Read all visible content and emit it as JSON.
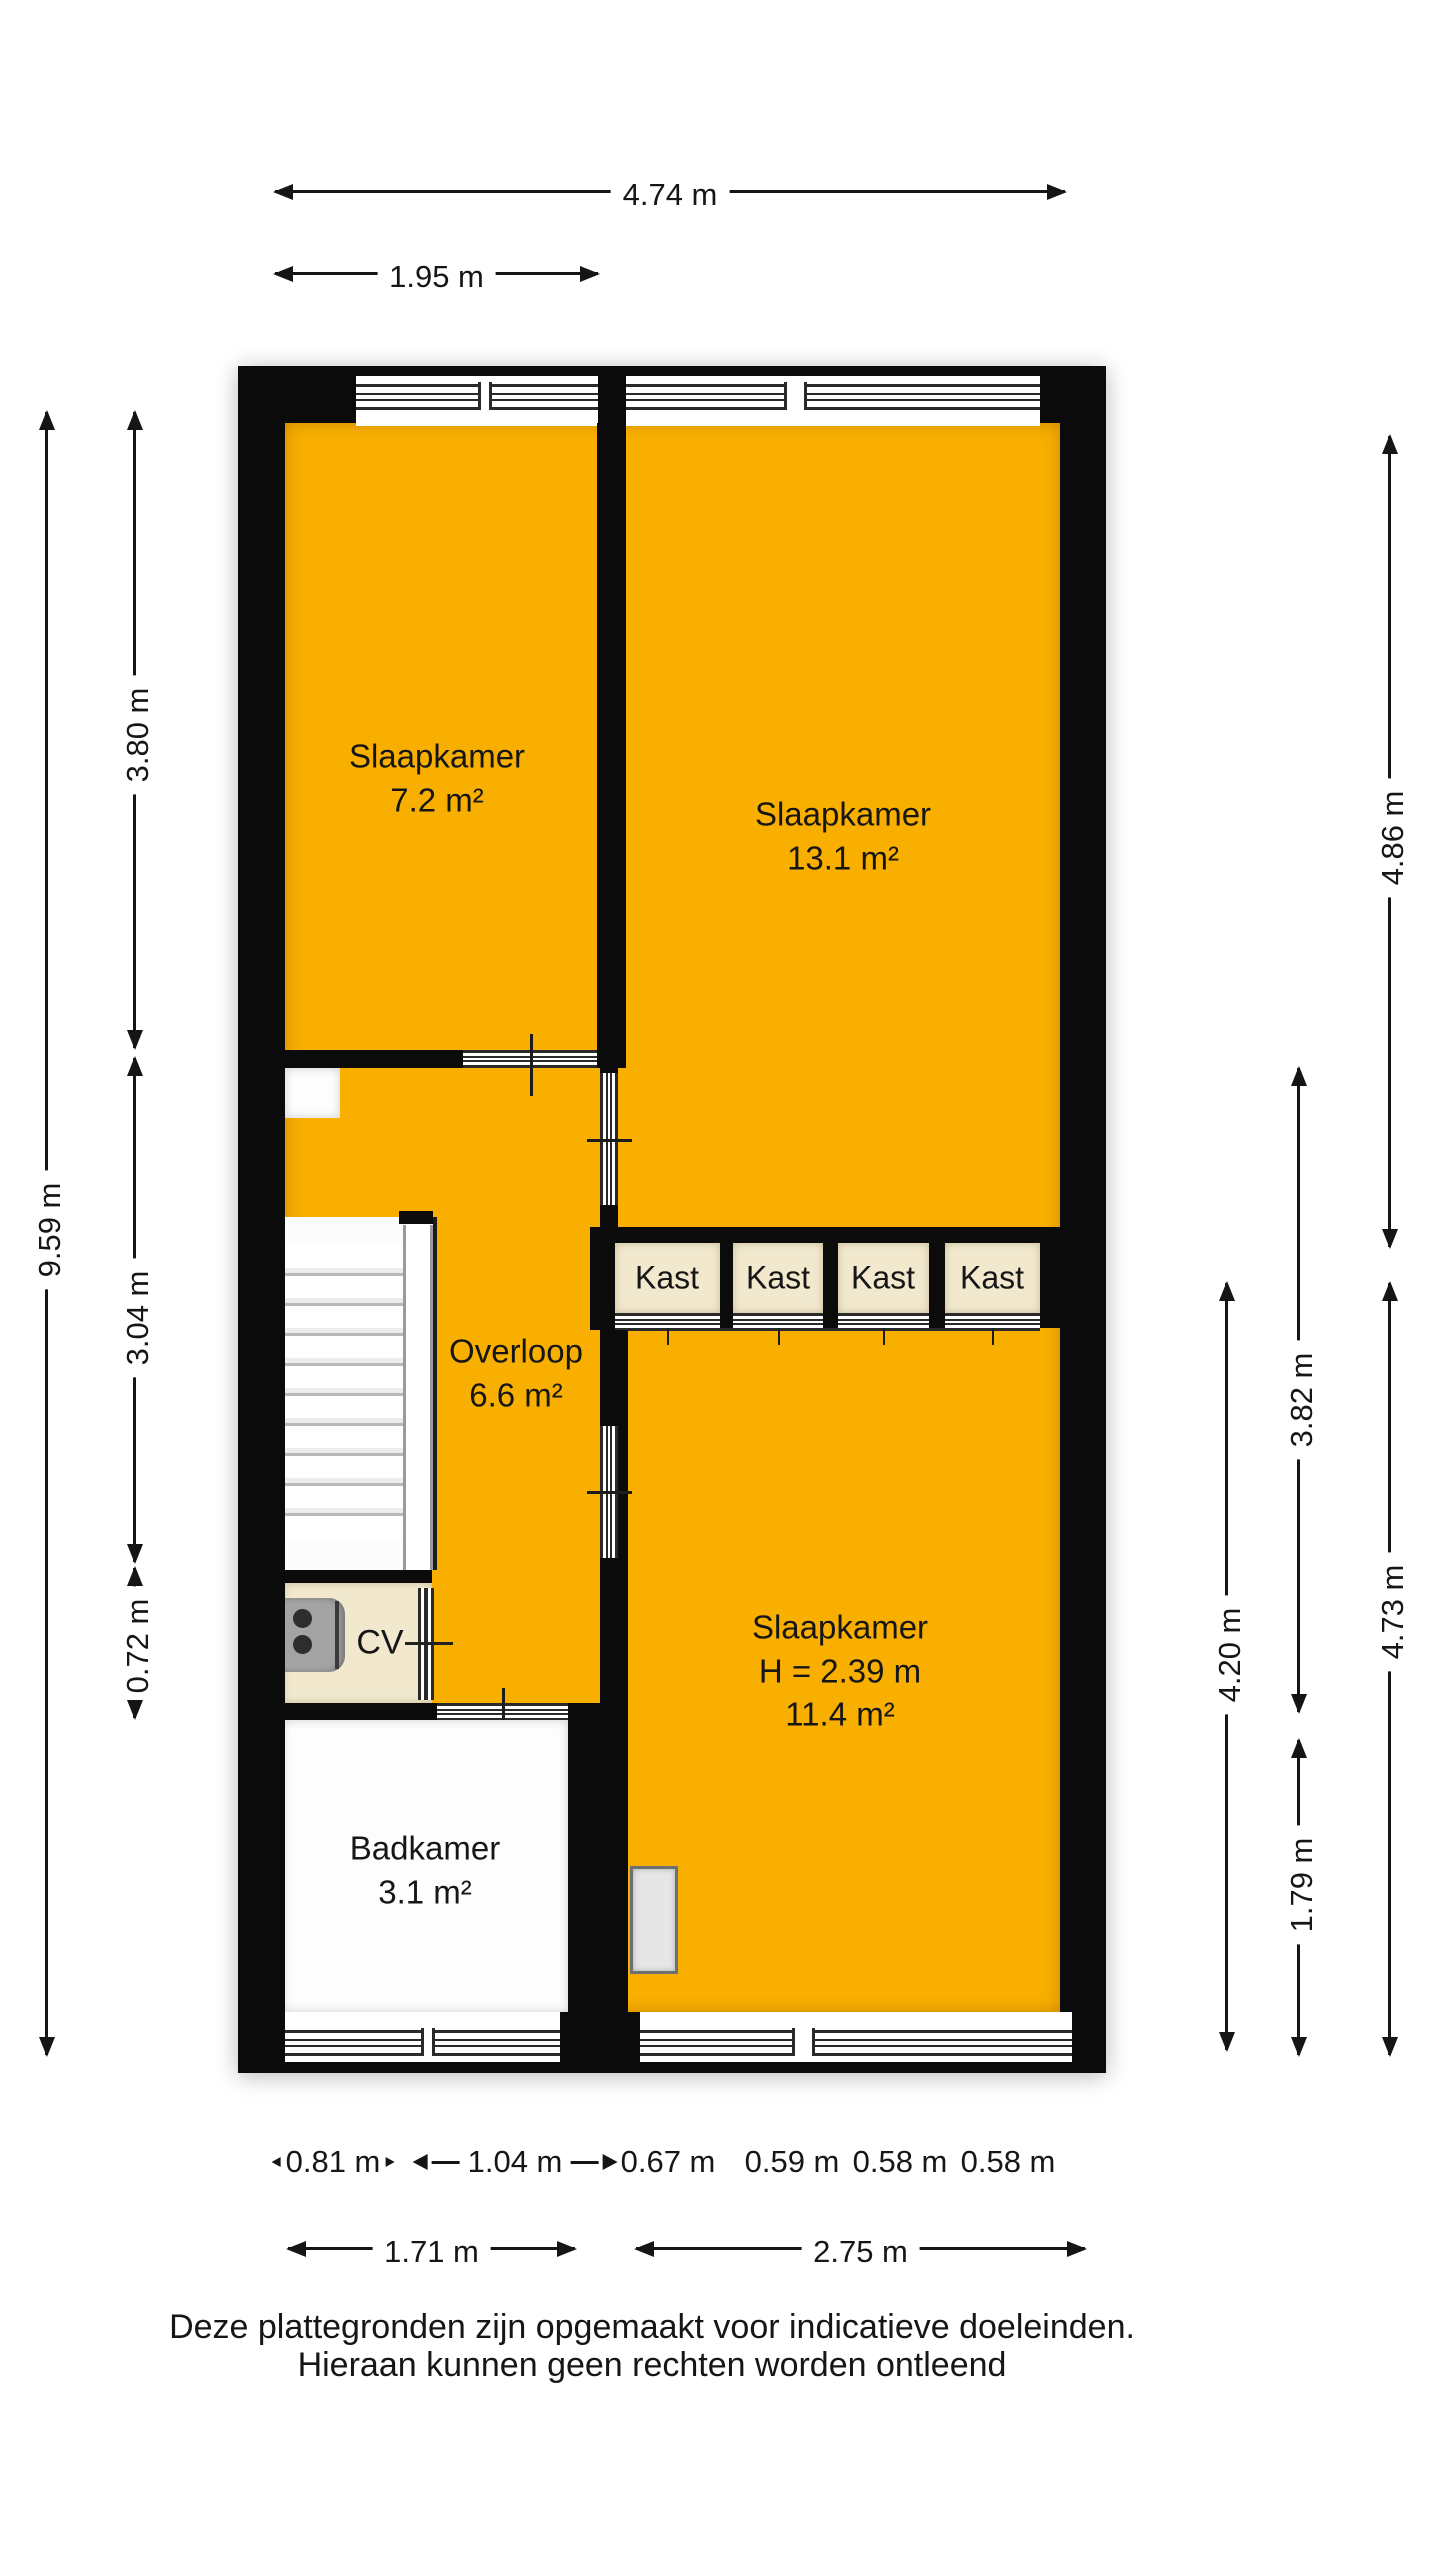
{
  "colors": {
    "room_fill": "#F8AF00",
    "closet_fill": "#F1E8CE",
    "wall": "#0B0B0B",
    "bathroom_fill": "#FDFDFD"
  },
  "rooms": {
    "slaapkamer_7": {
      "name": "Slaapkamer",
      "area": "7.2 m²"
    },
    "slaapkamer_13": {
      "name": "Slaapkamer",
      "area": "13.1 m²"
    },
    "overloop": {
      "name": "Overloop",
      "area": "6.6 m²"
    },
    "slaapkamer_11": {
      "name": "Slaapkamer",
      "height": "H = 2.39 m",
      "area": "11.4 m²"
    },
    "badkamer": {
      "name": "Badkamer",
      "area": "3.1 m²"
    },
    "cv": {
      "label": "CV"
    }
  },
  "kast": {
    "units": [
      "Kast",
      "Kast",
      "Kast",
      "Kast"
    ]
  },
  "dimensions": {
    "top_total": "4.74 m",
    "top_left": "1.95 m",
    "left_total": "9.59 m",
    "left_upper": "3.80 m",
    "left_middle": "3.04 m",
    "left_lower": "0.72 m",
    "right_outer_upper": "4.86 m",
    "right_outer_lower": "4.73 m",
    "right_mid_upper": "3.82 m",
    "right_mid_lower": "1.79 m",
    "right_inner": "4.20 m",
    "bottom_segments": [
      "0.81 m",
      "1.04 m",
      "0.67 m",
      "0.59 m",
      "0.58 m",
      "0.58 m"
    ],
    "bottom_totals": [
      "1.71 m",
      "2.75 m"
    ]
  },
  "footer": {
    "line1": "Deze plattegronden zijn opgemaakt voor indicatieve doeleinden.",
    "line2": "Hieraan kunnen geen rechten worden ontleend"
  }
}
